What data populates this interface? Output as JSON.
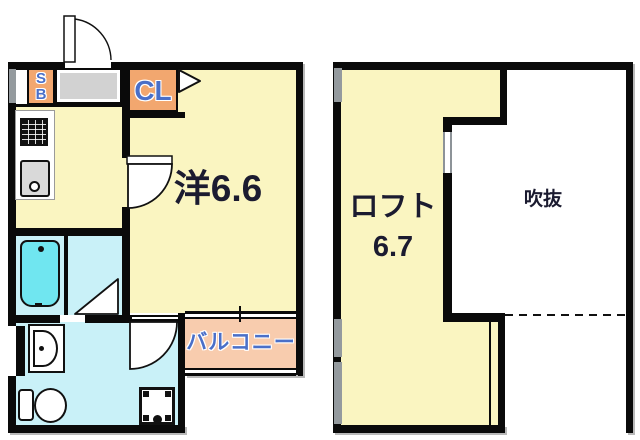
{
  "colors": {
    "wall": "#0a0a0a",
    "room_yellow": "#FAF5C1",
    "closet_orange": "#F2A76F",
    "balcony_peach": "#F8CCAE",
    "wet_cyan": "#C9F1F8",
    "tub_cyan": "#70E6F0",
    "entry_gray": "#D2D2D2",
    "window_gray": "#949A9E",
    "sink_gray": "#D9D9D9",
    "label_blue": "#4A6FC8",
    "label_dark": "#1B1B30"
  },
  "left_plan": {
    "shoebox_label_s": "S",
    "shoebox_label_b": "B",
    "closet_label": "CL",
    "main_room_label": "洋6.6",
    "balcony_label": "バルコニー"
  },
  "right_plan": {
    "loft_label": "ロフト",
    "loft_area_label": "6.7",
    "void_label": "吹抜"
  },
  "icons": {
    "entrance_door": "quarter-arc-door",
    "closet_door": "triangle-door",
    "room_door": "quarter-disc-door",
    "bathroom_door": "triangle-door",
    "washroom_door": "quarter-disc-door",
    "stove": "black-grid-square",
    "kitchen_sink": "gray-rounded-square-with-drain",
    "bathtub": "rounded-tub-with-faucet-dot",
    "washbasin": "d-shape-bowl",
    "toilet": "tank-and-bowl",
    "washer_pan": "square-pan-with-drain",
    "window": "gray-wall-strip",
    "void_boundary": "dashed-line"
  }
}
